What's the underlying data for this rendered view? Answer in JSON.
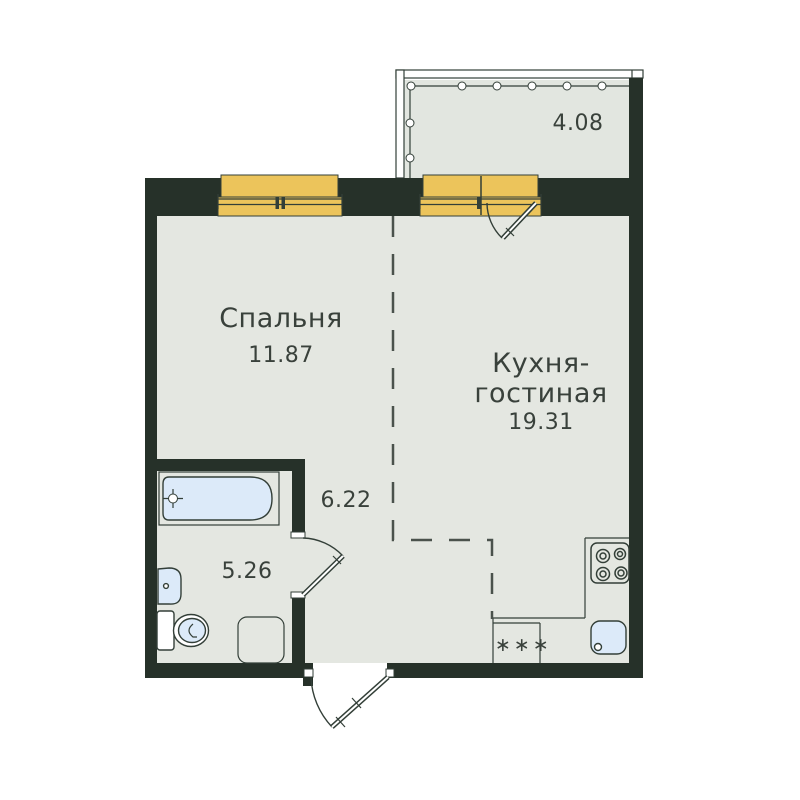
{
  "plan_title": "apartment-floor-plan",
  "rooms": {
    "bedroom": {
      "name": "Спальня",
      "area": "11.87"
    },
    "kitchen": {
      "name_line1": "Кухня-",
      "name_line2": "гостиная",
      "area": "19.31"
    },
    "hallway": {
      "area": "6.22"
    },
    "bathroom": {
      "area": "5.26"
    },
    "balcony": {
      "area": "4.08"
    }
  },
  "fixtures": {
    "fridge_label": "∗∗∗"
  },
  "colors": {
    "wall": "#263129",
    "floor": "#e4e7e1",
    "balcony_floor": "#e2e6e0",
    "window": "#ecc45b",
    "fixture_fill": "#dceaf9",
    "line": "#333f38",
    "text": "#39413b",
    "dash": "#4a524c",
    "background": "#ffffff"
  }
}
